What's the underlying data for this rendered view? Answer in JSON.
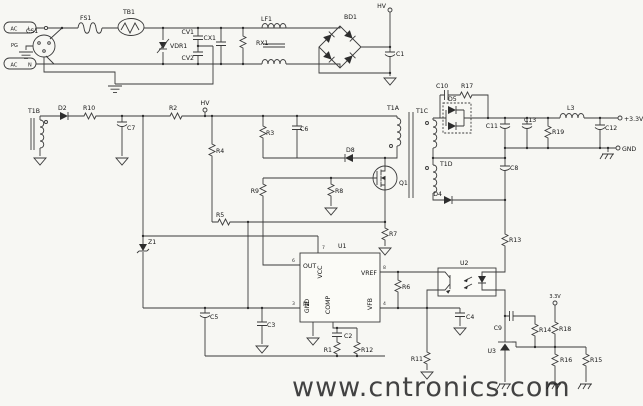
{
  "schematic": {
    "input": {
      "cs1": "CS1",
      "ac_l": "AC",
      "l": "L",
      "ac_n": "AC",
      "n": "N",
      "pg": "PG",
      "fs1": "FS1",
      "tb1": "TB1",
      "vdr1": "VDR1",
      "cv1": "CV1",
      "cv2": "CV2",
      "cx1": "CX1",
      "rx1": "RX1",
      "lf1": "LF1",
      "bd1": "BD1",
      "c1": "C1",
      "hv": "HV"
    },
    "aux": {
      "t1b": "T1B",
      "d2": "D2",
      "r10": "R10",
      "c7": "C7",
      "r2": "R2",
      "hv": "HV",
      "r4": "R4",
      "r5": "R5",
      "z1": "Z1",
      "c5": "C5",
      "c3": "C3"
    },
    "primary": {
      "r3": "R3",
      "c6": "C6",
      "d8": "D8",
      "t1a": "T1A",
      "q1": "Q1",
      "r9": "R9",
      "r8": "R8",
      "r7": "R7"
    },
    "controller": {
      "u1": "U1",
      "pin_out": "OUT",
      "pin_vcc": "VCC",
      "pin_vref": "VREF",
      "pin_in": "IN",
      "pin_gnd": "GND",
      "pin_comp": "COMP",
      "pin_vfb": "VFB",
      "pin3": "3",
      "pin4": "4",
      "pin6": "6",
      "pin7": "7",
      "pin8": "8",
      "c2": "C2",
      "r1": "R1",
      "r12": "R12",
      "r11": "R11",
      "r6": "R6",
      "c4": "C4"
    },
    "secondary": {
      "t1c": "T1C",
      "t1d": "T1D",
      "d5": "D5",
      "d4": "D4",
      "c8": "C8",
      "c10": "C10",
      "r17": "R17",
      "c11": "C11",
      "c13": "C13",
      "r19": "R19",
      "l3": "L3",
      "c12": "C12",
      "vout": "+3.3V",
      "gnd": "GND"
    },
    "feedback": {
      "r13": "R13",
      "u2": "U2",
      "c9": "C9",
      "r14": "R14",
      "v33": "3.3V",
      "r18": "R18",
      "u3": "U3",
      "r16": "R16",
      "r15": "R15"
    }
  },
  "watermark": {
    "text": "www.cntronics.com",
    "color": "#3fbf63"
  }
}
